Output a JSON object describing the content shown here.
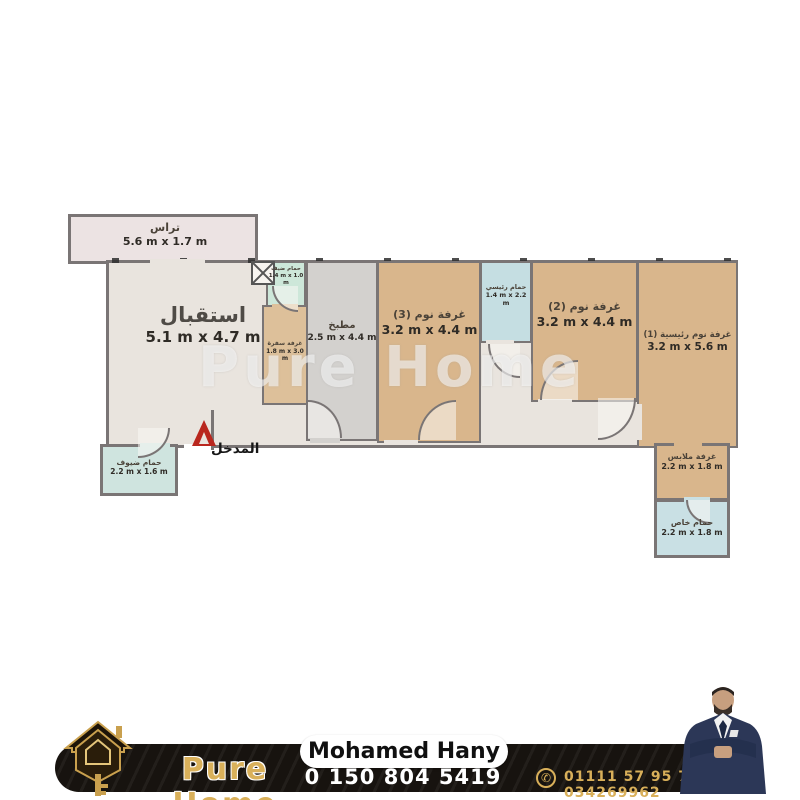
{
  "watermark": "Pure Home",
  "plan": {
    "rooms": {
      "terrace": {
        "label": "تراس",
        "dims": "5.6 m x 1.7 m"
      },
      "reception": {
        "label": "استقبال",
        "dims": "5.1 m x 4.7 m"
      },
      "guest_wc": {
        "label": "حمام ضيف",
        "dims": "1.4 m x 1.0 m"
      },
      "dining": {
        "label": "غرفة سفرة",
        "dims": "1.8 m x 3.0 m"
      },
      "kitchen": {
        "label": "مطبخ",
        "dims": "2.5 m x 4.4 m"
      },
      "bedroom3": {
        "label": "غرفة نوم (3)",
        "dims": "3.2 m x 4.4 m"
      },
      "main_bath": {
        "label": "حمام رئيسي",
        "dims": "1.4 m x 2.2 m"
      },
      "bedroom2": {
        "label": "غرفة نوم (2)",
        "dims": "3.2 m x 4.4 m"
      },
      "master_bedroom": {
        "label": "غرفة نوم رئيسية (1)",
        "dims": "3.2 m x 5.6 m"
      },
      "guest_bath": {
        "label": "حمام ضيوف",
        "dims": "2.2 m x 1.6 m"
      },
      "dressing": {
        "label": "غرفة ملابس",
        "dims": "2.2 m x 1.8 m"
      },
      "private_bath": {
        "label": "حمام خاص",
        "dims": "2.2 m x 1.8 m"
      },
      "entrance": {
        "label": "المدخل"
      }
    }
  },
  "footer": {
    "brand": "Pure Home",
    "agent_name": "Mohamed Hany",
    "phone_main": "0 150 804 5419",
    "phone_alt": "01111 57 95 79 — 034269962"
  },
  "icons": {
    "phone": "✆"
  },
  "colors": {
    "brand_gold": "#d9b05a",
    "bar_black": "#17130f",
    "wall_gray": "#7a7575",
    "bedroom_tan": "#d9b68c",
    "bath_blue": "#c9e0e4",
    "kitchen_gray": "#d3d1ce",
    "entrance_red": "#b9271e",
    "suit_navy": "#2c3757"
  }
}
